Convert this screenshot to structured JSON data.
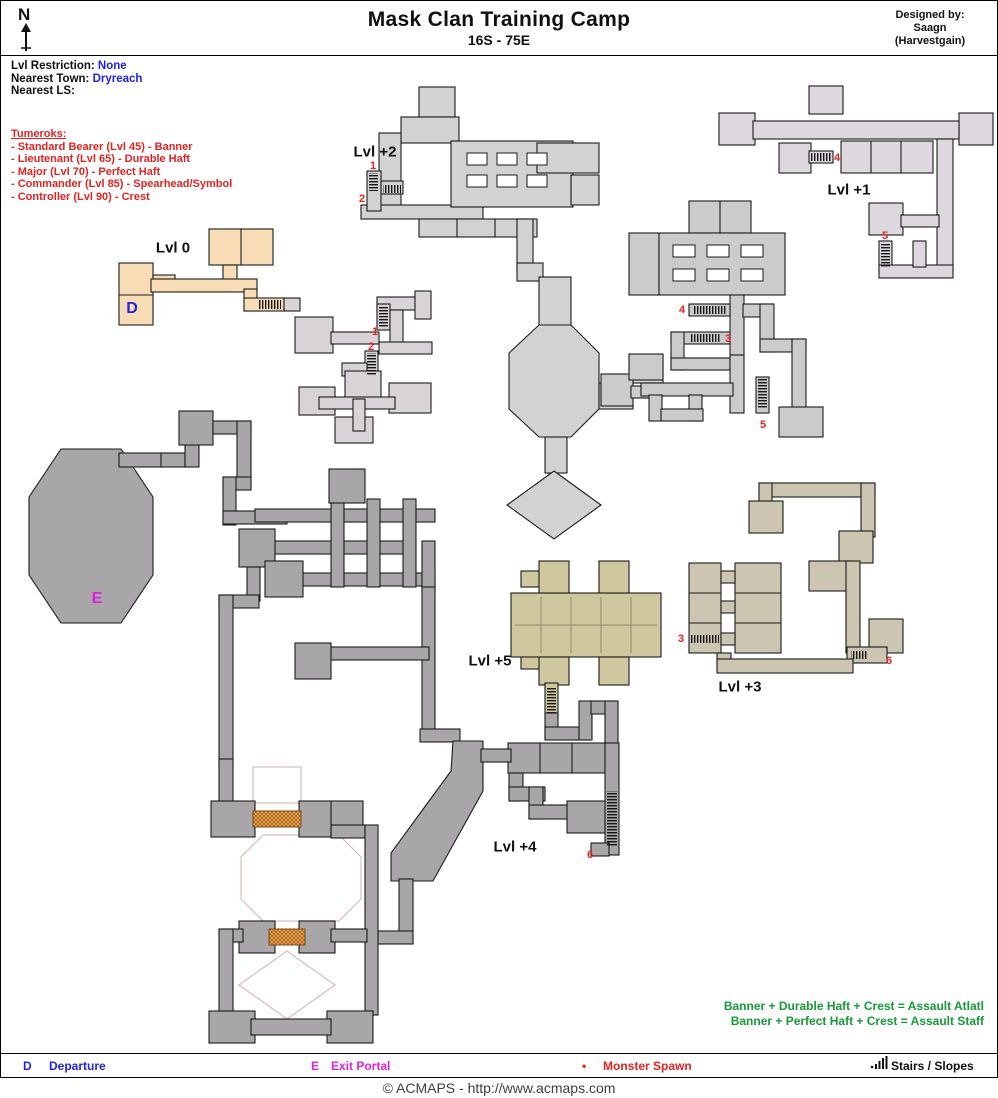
{
  "header": {
    "compass": "N",
    "title": "Mask Clan Training Camp",
    "subtitle": "16S - 75E",
    "designed_by": "Designed by:",
    "designer_line1": "Saagn",
    "designer_line2": "(Harvestgain)"
  },
  "info": {
    "restriction_label": "Lvl Restriction:",
    "restriction_value": "None",
    "town_label": "Nearest Town:",
    "town_value": "Dryreach",
    "ls_label": "Nearest LS:",
    "ls_value": ""
  },
  "monsters": {
    "heading": "Tumeroks:",
    "items": [
      "- Standard Bearer (Lvl 45) - Banner",
      "- Lieutenant (Lvl 65) - Durable Haft",
      "- Major (Lvl 70) - Perfect Haft",
      "- Commander (Lvl 85) - Spearhead/Symbol",
      "- Controller (Lvl 90) - Crest"
    ]
  },
  "map": {
    "level_labels": [
      {
        "text": "Lvl 0",
        "x": 172,
        "y": 247
      },
      {
        "text": "Lvl +2",
        "x": 374,
        "y": 151
      },
      {
        "text": "Lvl +1",
        "x": 848,
        "y": 189
      },
      {
        "text": "Lvl +3",
        "x": 739,
        "y": 686
      },
      {
        "text": "Lvl +5",
        "x": 489,
        "y": 660
      },
      {
        "text": "Lvl +4",
        "x": 514,
        "y": 846
      }
    ],
    "markers": [
      {
        "text": "D",
        "x": 131,
        "y": 308,
        "color": "#2222dd"
      },
      {
        "text": "E",
        "x": 96,
        "y": 598,
        "color": "#dd22dd"
      }
    ],
    "stair_numbers": [
      {
        "text": "1",
        "x": 372,
        "y": 165
      },
      {
        "text": "2",
        "x": 361,
        "y": 198
      },
      {
        "text": "1",
        "x": 374,
        "y": 331
      },
      {
        "text": "2",
        "x": 370,
        "y": 346
      },
      {
        "text": "4",
        "x": 836,
        "y": 157
      },
      {
        "text": "5",
        "x": 884,
        "y": 235
      },
      {
        "text": "4",
        "x": 681,
        "y": 309
      },
      {
        "text": "3",
        "x": 727,
        "y": 338
      },
      {
        "text": "5",
        "x": 762,
        "y": 424
      },
      {
        "text": "3",
        "x": 680,
        "y": 638
      },
      {
        "text": "6",
        "x": 888,
        "y": 660
      },
      {
        "text": "6",
        "x": 589,
        "y": 854
      }
    ]
  },
  "notes": {
    "combines": [
      "Banner + Durable Haft + Crest = Assault Atlatl",
      "Banner + Perfect Haft + Crest = Assault Staff"
    ]
  },
  "legend": {
    "departure_symbol": "D",
    "departure_label": "Departure",
    "exit_symbol": "E",
    "exit_label": "Exit Portal",
    "spawn_symbol": "•",
    "spawn_label": "Monster Spawn",
    "stairs_label": "Stairs / Slopes"
  },
  "footer": {
    "copyright": "© ACMAPS - http://www.acmaps.com"
  },
  "colors": {
    "level0": "#f8dcb6",
    "level1": "#dcd8de",
    "level2": "#d2d2d2",
    "level3": "#ccc5b2",
    "level4": "#a9a6a9",
    "level5": "#cfc89f",
    "marker_departure": "#2222dd",
    "marker_exit": "#dd22dd",
    "stair_number": "#e32222",
    "monster_text": "#e32222",
    "combine_text": "#189a38",
    "bridge": "#c98436"
  }
}
